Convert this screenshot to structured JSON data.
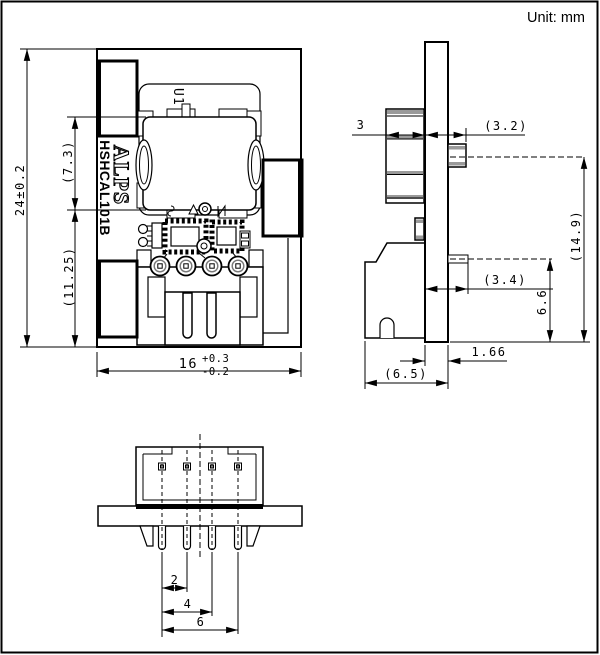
{
  "unit_label": "Unit: mm",
  "front_view": {
    "labels": {
      "ref_designator": "U1",
      "brand": "ALPS",
      "part_number": "HSHCAL101B"
    },
    "dims": {
      "overall_height": "24±0.2",
      "sensor_section_height": "(7.3)",
      "lower_section_height": "(11.25)",
      "overall_width": "16",
      "width_tol_plus": "+0.3",
      "width_tol_minus": "-0.2"
    }
  },
  "side_view": {
    "dims": {
      "sensor_thickness": "3",
      "upper_pin_length": "(3.2)",
      "upper_pin_height": "(14.9)",
      "lower_pin_length": "(3.4)",
      "lower_pin_height": "6.6",
      "pcb_thickness": "1.66",
      "connector_depth": "(6.5)"
    }
  },
  "bottom_view": {
    "dims": {
      "pin_pitch_2": "2",
      "pin_pitch_4": "4",
      "pin_pitch_6": "6"
    }
  },
  "colors": {
    "line": "#000000",
    "shade": "#9a9a9a",
    "background": "#ffffff"
  }
}
